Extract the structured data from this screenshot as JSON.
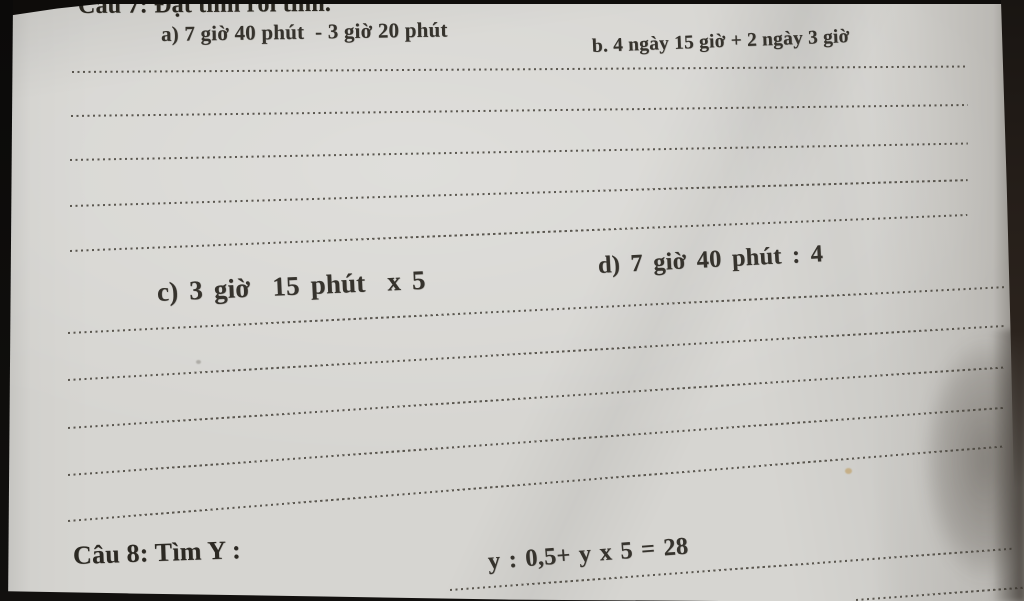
{
  "worksheet": {
    "question7": {
      "heading": "Câu 7: Đặt tính rồi tính.",
      "part_a": "a) 7 giờ 40 phút  - 3 giờ 20 phút",
      "part_b": "b. 4 ngày 15 giờ + 2 ngày 3 giờ",
      "part_c": "c) 3 giờ  15 phút  x 5",
      "part_d": "d) 7 giờ 40 phút : 4"
    },
    "question8": {
      "heading": "Câu 8: Tìm Y :",
      "equation": "y : 0,5+ y x 5 = 28"
    },
    "colors": {
      "paper": "#d6d5d1",
      "ink": "#36332d",
      "dotted_line": "#48443c",
      "background": "#141110"
    }
  }
}
